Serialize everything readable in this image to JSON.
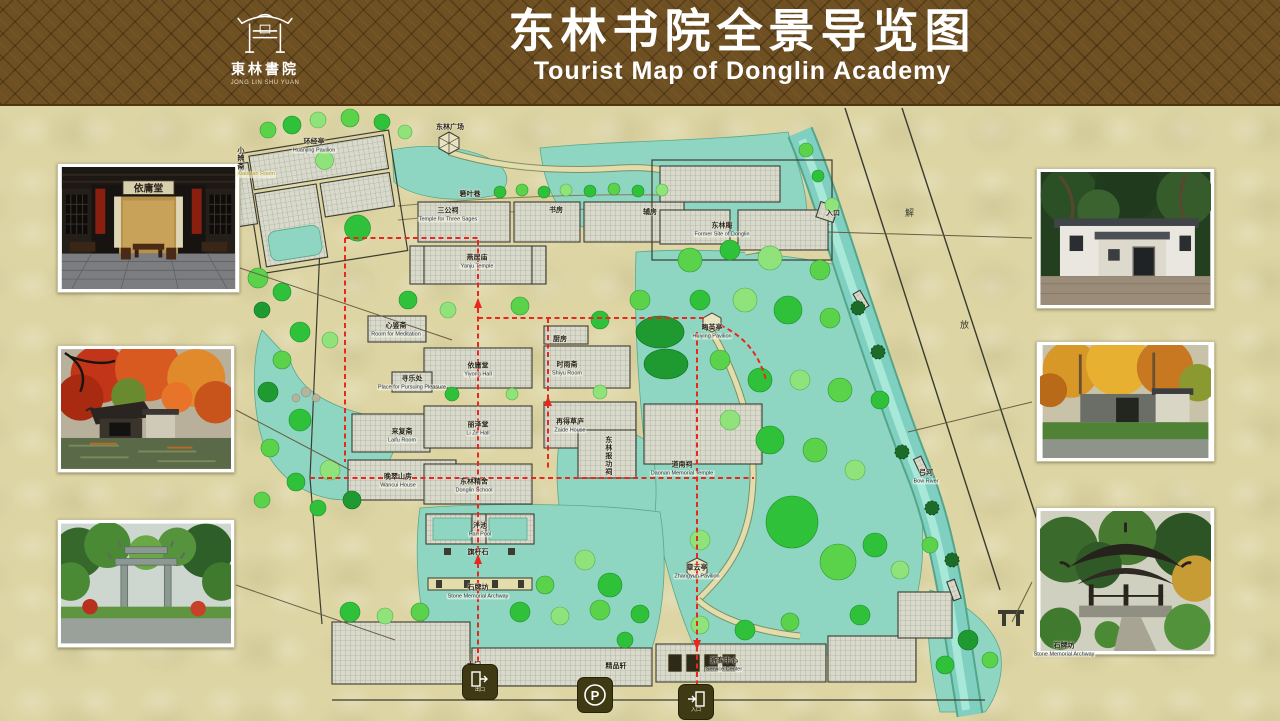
{
  "banner": {
    "title_zh": "东林书院全景导览图",
    "title_en": "Tourist Map of Donglin Academy",
    "logo": {
      "name_zh": "東林書院",
      "name_en": "JONG LIN SHU YUAN"
    }
  },
  "map": {
    "road_chars": [
      "解",
      "放"
    ],
    "route_color": "#e8281e",
    "water_color": "#8ed6c2",
    "labels": [
      {
        "id": "donglin-square",
        "zh": "东林广场",
        "en": "",
        "x": 450,
        "y": 128
      },
      {
        "id": "huanjing-pavilion",
        "zh": "环经亭",
        "en": "Huanjing Pavilion",
        "x": 314,
        "y": 146
      },
      {
        "id": "xiaobian-room",
        "zh": "小辨斋",
        "en": "Xiaobian Room",
        "x": 256,
        "y": 162,
        "vertical": true,
        "en_color": "#b89a20"
      },
      {
        "id": "ruoye-lane",
        "zh": "箬叶巷",
        "en": "",
        "x": 470,
        "y": 195
      },
      {
        "id": "sangong-temple",
        "zh": "三公祠",
        "en": "Temple for Three Sages",
        "x": 448,
        "y": 215
      },
      {
        "id": "study-rooms",
        "zh": "书房",
        "en": "",
        "x": 556,
        "y": 211
      },
      {
        "id": "auxiliary-rooms",
        "zh": "辅房",
        "en": "",
        "x": 650,
        "y": 213
      },
      {
        "id": "yanju-temple",
        "zh": "燕居庙",
        "en": "Yanju Temple",
        "x": 477,
        "y": 262
      },
      {
        "id": "donglin-an",
        "zh": "东林庵",
        "en": "Former Site of Donglin",
        "x": 722,
        "y": 230
      },
      {
        "id": "entrance-label",
        "zh": "入口",
        "en": "",
        "x": 833,
        "y": 214
      },
      {
        "id": "xinjian-room",
        "zh": "心鉴斋",
        "en": "Room for Meditation",
        "x": 396,
        "y": 330
      },
      {
        "id": "xunle-place",
        "zh": "寻乐处",
        "en": "Place for Pursuing Pleasure",
        "x": 412,
        "y": 383
      },
      {
        "id": "kitchen",
        "zh": "厨房",
        "en": "",
        "x": 560,
        "y": 340
      },
      {
        "id": "shiyu-room",
        "zh": "时雨斋",
        "en": "Shiyu Room",
        "x": 567,
        "y": 369
      },
      {
        "id": "yiyong-hall",
        "zh": "依庸堂",
        "en": "Yiyong Hall",
        "x": 478,
        "y": 370
      },
      {
        "id": "laifu-room",
        "zh": "来复斋",
        "en": "Laifu Room",
        "x": 402,
        "y": 436
      },
      {
        "id": "lize-hall",
        "zh": "丽泽堂",
        "en": "Li Ze Hall",
        "x": 478,
        "y": 429
      },
      {
        "id": "zaide-house",
        "zh": "再得草庐",
        "en": "Zaide House",
        "x": 570,
        "y": 426
      },
      {
        "id": "wancui-house",
        "zh": "晚翠山房",
        "en": "Wancui House",
        "x": 398,
        "y": 481
      },
      {
        "id": "baogong-shrine",
        "zh": "东林报功祠",
        "en": "",
        "x": 608,
        "y": 456,
        "vertical": true
      },
      {
        "id": "daonan-temple",
        "zh": "道南祠",
        "en": "Daonan Memorial Temple",
        "x": 682,
        "y": 469
      },
      {
        "id": "huiying-pavilion",
        "zh": "晦英亭",
        "en": "Huiying Pavilion",
        "x": 712,
        "y": 332
      },
      {
        "id": "bow-river",
        "zh": "弓河",
        "en": "Bow River",
        "x": 926,
        "y": 477
      },
      {
        "id": "donglin-school",
        "zh": "东林精舍",
        "en": "Donglin School",
        "x": 474,
        "y": 486
      },
      {
        "id": "pan-pool",
        "zh": "泮池",
        "en": "Pan Pool",
        "x": 480,
        "y": 530
      },
      {
        "id": "flagpole-stone",
        "zh": "旗杆石",
        "en": "",
        "x": 478,
        "y": 553
      },
      {
        "id": "stone-archway",
        "zh": "石牌坊",
        "en": "Stone Memorial Archway",
        "x": 478,
        "y": 592
      },
      {
        "id": "zhangyun-pavilion",
        "zh": "章云亭",
        "en": "Zhangyun Pavilion",
        "x": 697,
        "y": 572
      },
      {
        "id": "boutique-shop",
        "zh": "精品轩",
        "en": "",
        "x": 616,
        "y": 667
      },
      {
        "id": "main-gate",
        "zh": "大门",
        "en": "",
        "x": 474,
        "y": 666
      },
      {
        "id": "service-center",
        "zh": "游客中心",
        "en": "Service Center",
        "x": 724,
        "y": 665
      },
      {
        "id": "stone-archway-2",
        "zh": "石牌坊",
        "en": "Stone Memorial Archway",
        "x": 1064,
        "y": 650
      }
    ]
  },
  "photos": {
    "yiyong_plaque": "依庸堂"
  },
  "icons": {
    "exit": {
      "label": "出口"
    },
    "parking": {
      "label": "P"
    },
    "entrance": {
      "label": "入口"
    }
  }
}
